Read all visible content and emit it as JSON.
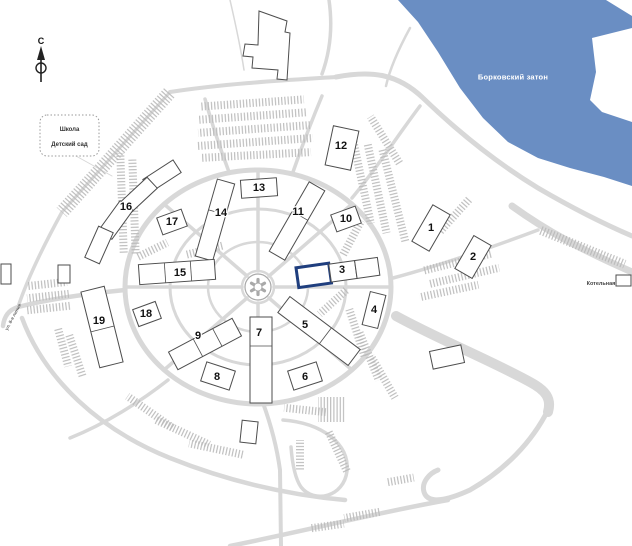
{
  "map": {
    "north_label": "С",
    "water": {
      "label": "Борковский затон",
      "color": "#6A8EC3"
    },
    "school_box": {
      "line1": "Школа",
      "line2": "Детский сад"
    },
    "street_label": "ул. 8-я линия",
    "boiler_label": "Котельная",
    "highlighted_building": "3",
    "colors": {
      "road": "#D8D8D8",
      "hatch": "#B9B9B9",
      "outline": "#4D4D4D",
      "highlight": "#1F3E7E"
    },
    "buildings": [
      {
        "label": "1"
      },
      {
        "label": "2"
      },
      {
        "label": "3"
      },
      {
        "label": "4"
      },
      {
        "label": "5"
      },
      {
        "label": "6"
      },
      {
        "label": "7"
      },
      {
        "label": "8"
      },
      {
        "label": "9"
      },
      {
        "label": "10"
      },
      {
        "label": "11"
      },
      {
        "label": "12"
      },
      {
        "label": "13"
      },
      {
        "label": "14"
      },
      {
        "label": "15"
      },
      {
        "label": "16"
      },
      {
        "label": "17"
      },
      {
        "label": "18"
      },
      {
        "label": "19"
      }
    ]
  }
}
